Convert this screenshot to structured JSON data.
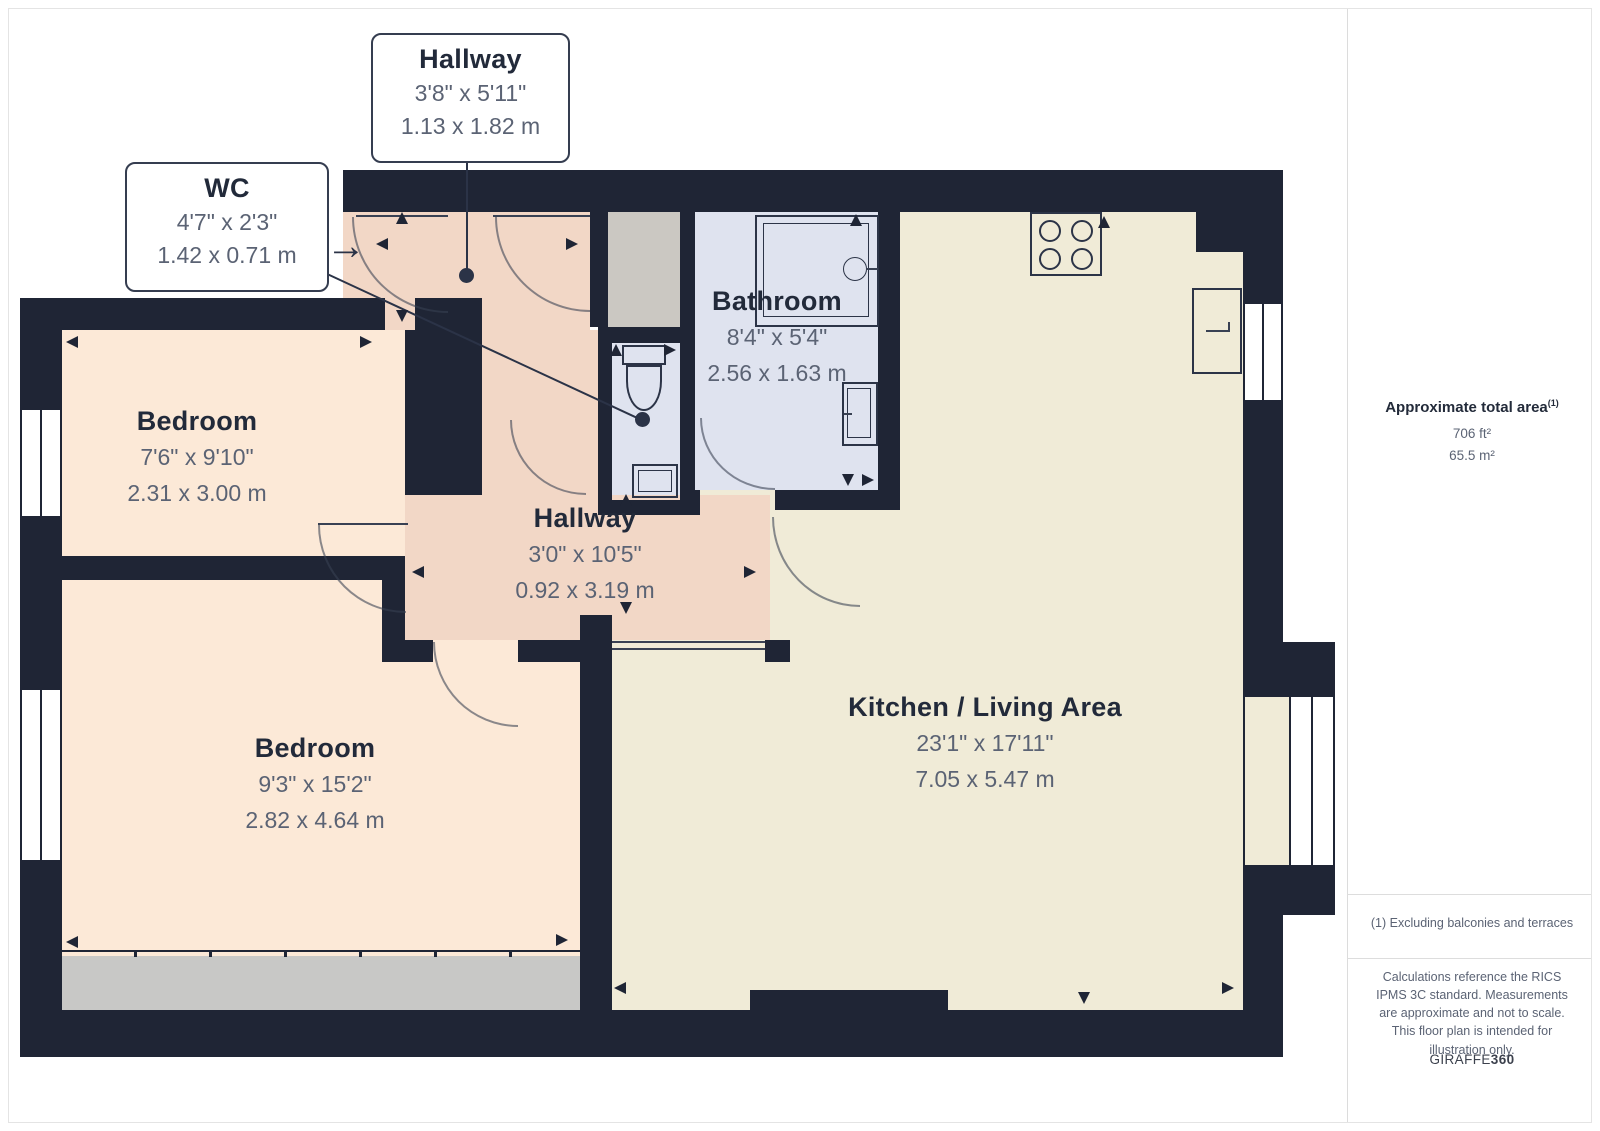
{
  "callouts": {
    "hallway_top": {
      "title": "Hallway",
      "imperial": "3'8\" x 5'11\"",
      "metric": "1.13 x 1.82 m"
    },
    "wc": {
      "title": "WC",
      "imperial": "4'7\" x 2'3\"",
      "metric": "1.42 x 0.71 m"
    }
  },
  "rooms": {
    "bedroom_1": {
      "title": "Bedroom",
      "imperial": "7'6\" x 9'10\"",
      "metric": "2.31 x 3.00 m"
    },
    "bathroom": {
      "title": "Bathroom",
      "imperial": "8'4\" x 5'4\"",
      "metric": "2.56 x 1.63 m"
    },
    "hallway_mid": {
      "title": "Hallway",
      "imperial": "3'0\" x 10'5\"",
      "metric": "0.92 x 3.19 m"
    },
    "bedroom_2": {
      "title": "Bedroom",
      "imperial": "9'3\" x 15'2\"",
      "metric": "2.82 x 4.64 m"
    },
    "kitchen_living": {
      "title": "Kitchen / Living Area",
      "imperial": "23'1\" x 17'11\"",
      "metric": "7.05 x 5.47 m"
    }
  },
  "sidebar": {
    "area_heading": "Approximate total area",
    "area_heading_sup": "(1)",
    "area_ft": "706 ft²",
    "area_m": "65.5 m²",
    "footnote": "(1) Excluding balconies and terraces",
    "disclaimer": "Calculations reference the RICS IPMS 3C standard. Measurements are approximate and not to scale. This floor plan is intended for illustration only.",
    "brand_name": "GIRAFFE",
    "brand_number": "360"
  },
  "icons": {
    "entrance_arrow": "→"
  },
  "colors": {
    "wall": "#1f2535",
    "hallway": "#f2d7c6",
    "bedroom": "#fce9d7",
    "kitchen": "#f0ebd7",
    "bathroom": "#dfe3ef",
    "closet": "#cbc8c2",
    "wardrobe": "#c8c8c6"
  }
}
